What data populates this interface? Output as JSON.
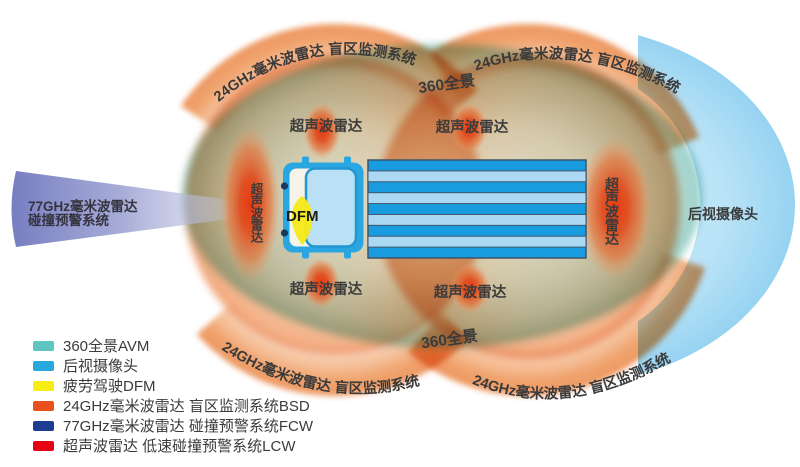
{
  "labels": {
    "arc_top_left": "24GHz毫米波雷达  盲区监测系统",
    "arc_top_right": "24GHz毫米波雷达  盲区监测系统",
    "arc_bottom_left": "24GHz毫米波雷达  盲区监测系统",
    "arc_bottom_right": "24GHz毫米波雷达  盲区监测系统",
    "panorama_top": "360全景",
    "panorama_bottom": "360全景",
    "ultrasonic_top_left": "超声波雷达",
    "ultrasonic_top_right": "超声波雷达",
    "ultrasonic_bottom_left": "超声波雷达",
    "ultrasonic_bottom_right": "超声波雷达",
    "ultrasonic_front": "超声波雷达",
    "ultrasonic_rear": "超声波雷达",
    "front_radar_line1": "77GHz毫米波雷达",
    "front_radar_line2": "碰撞预警系统",
    "rear_camera": "后视摄像头",
    "dfm": "DFM"
  },
  "legend": {
    "items": [
      {
        "name": "avm",
        "color": "#5fc5c2",
        "label": "360全景AVM"
      },
      {
        "name": "rear-camera",
        "color": "#29a8e0",
        "label": "后视摄像头"
      },
      {
        "name": "dfm",
        "color": "#f7ec13",
        "label": "疲劳驾驶DFM"
      },
      {
        "name": "bsd",
        "color": "#e8511d",
        "label": "24GHz毫米波雷达 盲区监测系统BSD"
      },
      {
        "name": "fcw",
        "color": "#1d3e90",
        "label": "77GHz毫米波雷达 碰撞预警系统FCW"
      },
      {
        "name": "lcw",
        "color": "#e60114",
        "label": "超声波雷达 低速碰撞预警系统LCW"
      }
    ]
  },
  "colors": {
    "avm_zone": "#9ed1c9",
    "bsd_zone": "#ec8244",
    "ultrasonic_zone": "#e63a10",
    "fcw_cone": "#7279bf",
    "rear_camera_fan": "#a8dcf5",
    "dfm_fan": "#f5e91c",
    "truck_blue": "#2aa7e1",
    "trailer_light": "#abd9f4"
  }
}
